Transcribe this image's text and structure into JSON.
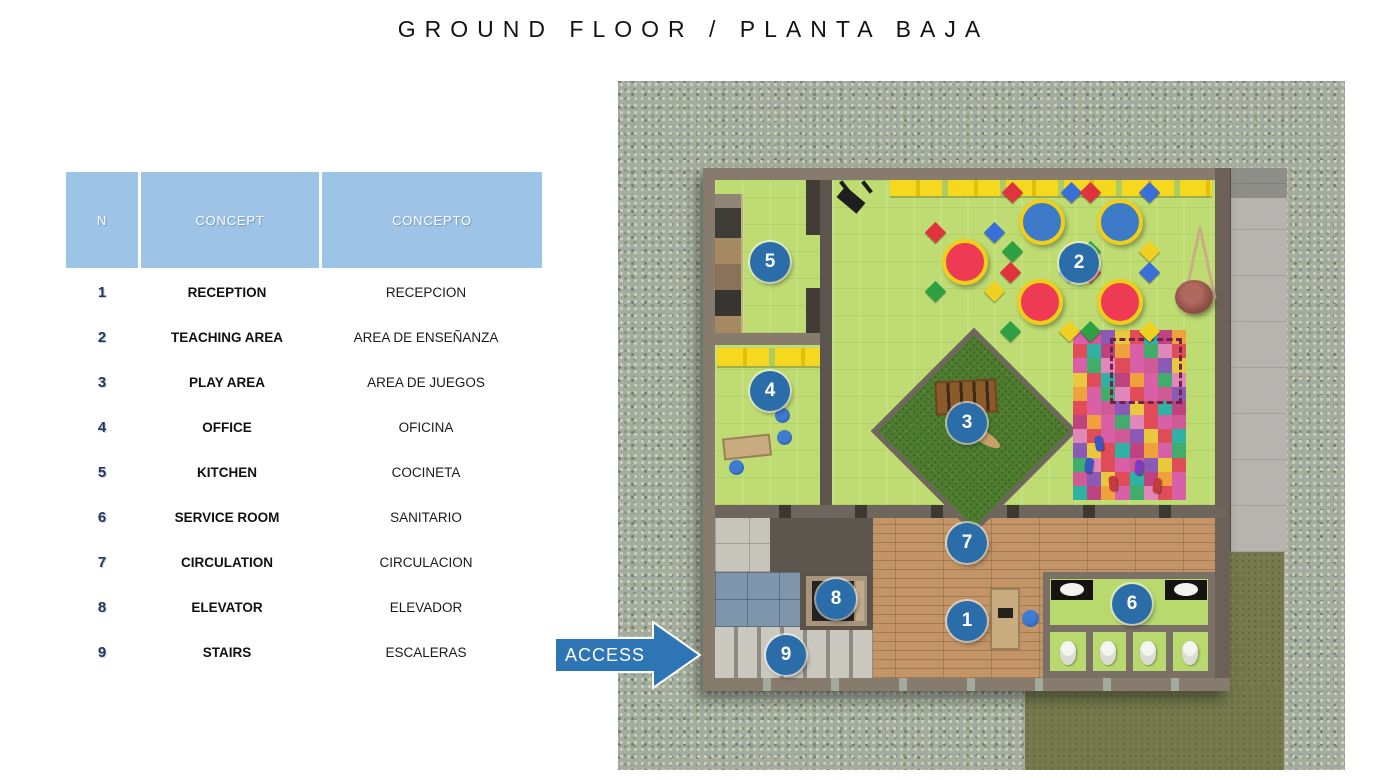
{
  "title": "GROUND FLOOR / PLANTA BAJA",
  "access": {
    "label": "ACCESS"
  },
  "colors": {
    "accent": "#2E75B6",
    "marker_blue": "#2B6DA9",
    "header_bg": "#9DC3E6",
    "number_navy": "#24365C",
    "table_red": "#EE3A52",
    "table_blue": "#3D7BC8",
    "bench_yellow": "#F6D81F",
    "floor_green": "#BEDC72",
    "play_grass_green": "#4E7C2E",
    "wood_floor": "#C29467",
    "wall_taupe": "#877B6E"
  },
  "legend": {
    "headers": {
      "n": "N",
      "concept": "CONCEPT",
      "concepto": "CONCEPTO"
    },
    "rows": [
      {
        "n": "1",
        "concept": "RECEPTION",
        "concepto": "RECEPCION"
      },
      {
        "n": "2",
        "concept": "TEACHING AREA",
        "concepto": "AREA DE ENSEÑANZA"
      },
      {
        "n": "3",
        "concept": "PLAY AREA",
        "concepto": "AREA DE JUEGOS"
      },
      {
        "n": "4",
        "concept": "OFFICE",
        "concepto": "OFICINA"
      },
      {
        "n": "5",
        "concept": "KITCHEN",
        "concepto": "COCINETA"
      },
      {
        "n": "6",
        "concept": "SERVICE ROOM",
        "concepto": "SANITARIO"
      },
      {
        "n": "7",
        "concept": "CIRCULATION",
        "concepto": "CIRCULACION"
      },
      {
        "n": "8",
        "concept": "ELEVATOR",
        "concepto": "ELEVADOR"
      },
      {
        "n": "9",
        "concept": "STAIRS",
        "concepto": "ESCALERAS"
      }
    ]
  },
  "plan": {
    "markers": [
      {
        "n": "1",
        "label": "reception",
        "x": 264,
        "y": 453
      },
      {
        "n": "2",
        "label": "teaching-area",
        "x": 376,
        "y": 95
      },
      {
        "n": "3",
        "label": "play-area",
        "x": 264,
        "y": 255
      },
      {
        "n": "4",
        "label": "office",
        "x": 67,
        "y": 223
      },
      {
        "n": "5",
        "label": "kitchen",
        "x": 67,
        "y": 94
      },
      {
        "n": "6",
        "label": "service-room",
        "x": 429,
        "y": 436
      },
      {
        "n": "7",
        "label": "circulation",
        "x": 264,
        "y": 375
      },
      {
        "n": "8",
        "label": "elevator",
        "x": 133,
        "y": 431
      },
      {
        "n": "9",
        "label": "stairs",
        "x": 83,
        "y": 487
      }
    ],
    "tables": [
      {
        "color": "#EE3A52",
        "x": 262,
        "y": 94
      },
      {
        "color": "#3D7BC8",
        "x": 339,
        "y": 54
      },
      {
        "color": "#3D7BC8",
        "x": 417,
        "y": 54
      },
      {
        "color": "#EE3A52",
        "x": 337,
        "y": 134
      },
      {
        "color": "#EE3A52",
        "x": 417,
        "y": 134
      }
    ],
    "mat_palette": [
      "#d960a6",
      "#e04c58",
      "#e287b9",
      "#41ad6c",
      "#d960a6",
      "#efa23b",
      "#bf4380",
      "#2fb1a3",
      "#e04c58",
      "#e8c83d",
      "#8a5ab6",
      "#d05a96"
    ]
  }
}
